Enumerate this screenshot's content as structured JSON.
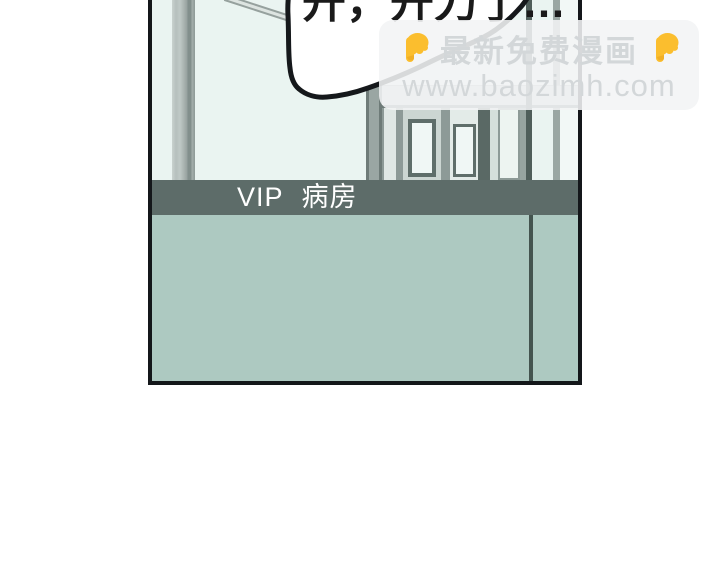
{
  "panel": {
    "sign": {
      "vip": "VIP",
      "ward": "病房"
    },
    "colors": {
      "band": "#5d6c69",
      "band_text": "#ffffff",
      "upper_wall": "#eaf4f1",
      "lower_wall": "#adc9c1",
      "frame_border": "#14171a",
      "dark_post": "#4f5e5a"
    }
  },
  "speech_bubble": {
    "text": "开，开刀了…",
    "fill": "#ffffff",
    "outline": "#15181b"
  },
  "watermark": {
    "line1": "最新免费漫画",
    "line2": "www.baozimh.com",
    "emoji": "backhand-index-pointing-down",
    "emoji_color": "#FBBE2E",
    "text_color": "#d3d7d9"
  }
}
